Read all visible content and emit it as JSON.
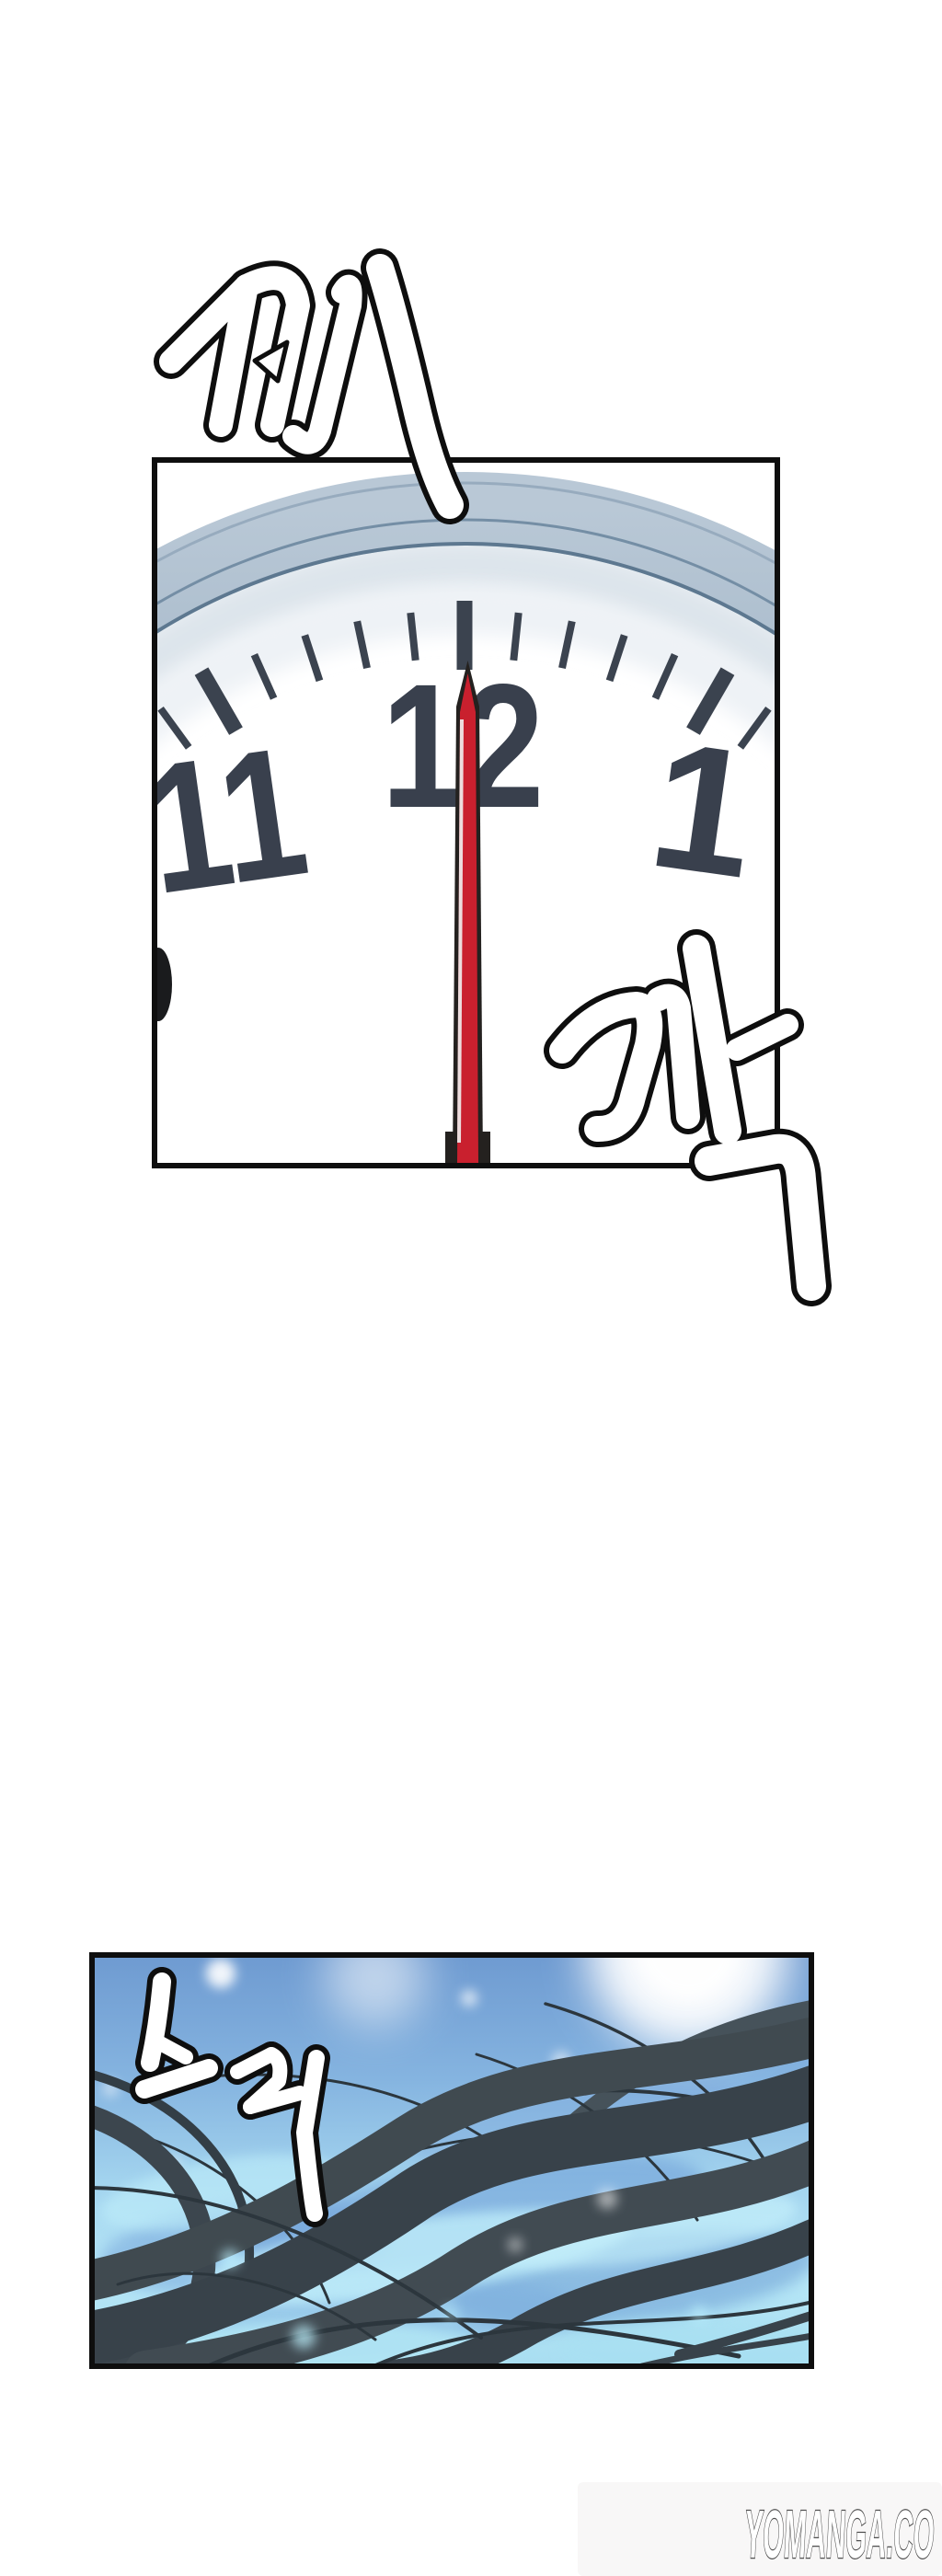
{
  "page": {
    "background_color": "#ffffff"
  },
  "clock_panel": {
    "border_color": "#0e0e0e",
    "rim_color": "#7d96ad",
    "face_color": "#ffffff",
    "tick_color": "#3b434f",
    "numeral_color": "#39404d",
    "numerals": [
      "11",
      "12",
      "1"
    ],
    "second_hand": {
      "color": "#c9202e",
      "highlight": "#f2f2f2",
      "outline": "#24211f",
      "pointing_at": "12"
    }
  },
  "underwater_panel": {
    "border_color": "#0e0e0e",
    "water_colors": [
      "#6f9bd1",
      "#85b4e0",
      "#a2d3ee",
      "#b7e7f7"
    ],
    "wave_light": "#c2f0fb",
    "wave_deep": "#6d9cd6",
    "hair_color": "#3f4a50",
    "sparkle_color": "#ffffff"
  },
  "sfx": [
    {
      "id": "jjae",
      "text": "째",
      "style": "white fill, black outline"
    },
    {
      "id": "kkak",
      "text": "깍",
      "style": "white fill, black outline"
    },
    {
      "id": "seureuk",
      "text": "스륵",
      "style": "white fill, black outline"
    }
  ],
  "watermark": {
    "text": "YOMANGA.CO",
    "fill": "#ffffff",
    "outline": "#4f4f4f"
  }
}
